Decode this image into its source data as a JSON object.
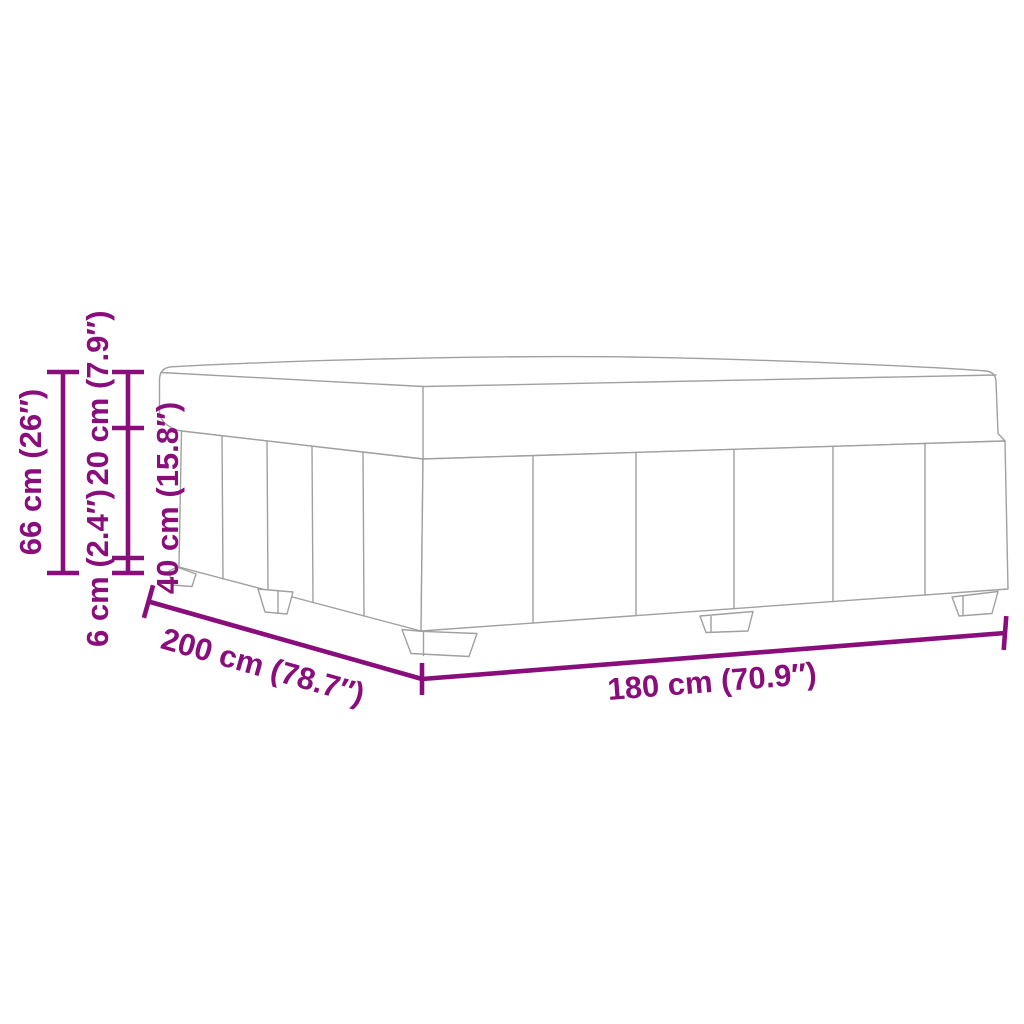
{
  "diagram": {
    "kind": "product-dimension-diagram",
    "subject": "upholstered box-spring bed base line drawing, perspective view, five tapered feet, paneled fabric sides",
    "colors": {
      "annotation_purple": "#890e7b",
      "outline_gray": "#a0a0a0",
      "background": "#ffffff"
    },
    "dimensions": {
      "height_total": "66 cm (26″)",
      "height_top": "20 cm (7.9″)",
      "height_legs": "6 cm (2.4″)",
      "height_base": "40 cm (15.8″)",
      "side_length": "200 cm (78.7″)",
      "front_width": "180 cm (70.9″)"
    }
  }
}
